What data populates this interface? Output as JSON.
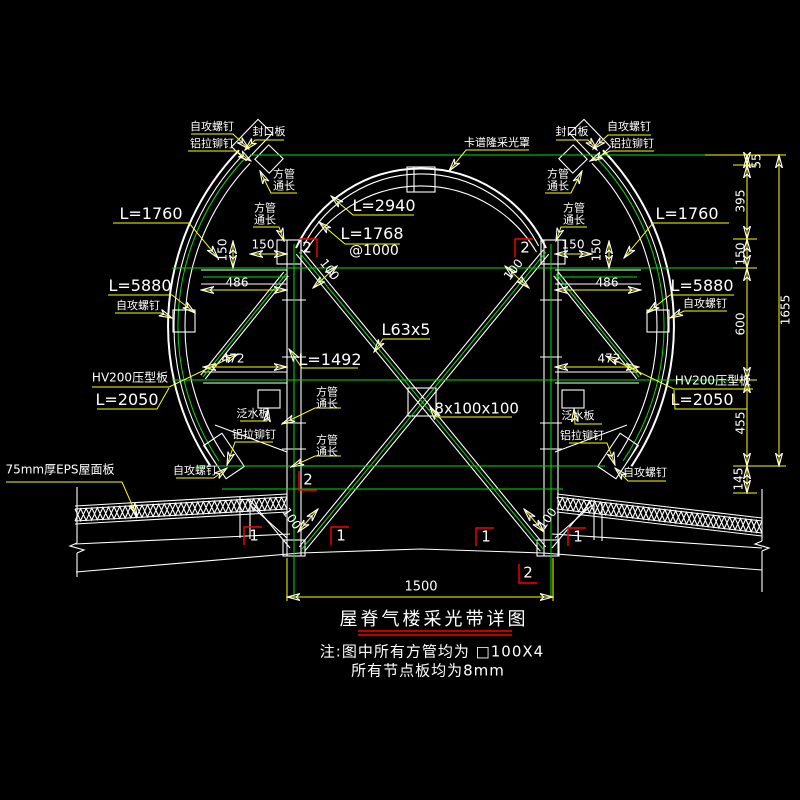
{
  "colors": {
    "background": "#000000",
    "line_white": "#ffffff",
    "axis_green": "#00e000",
    "dim_yellow": "#ffff00",
    "marker_red": "#ff0000"
  },
  "title_block": {
    "title": "屋脊气楼采光带详图",
    "note_line1": "注:图中所有方管均为 □100X4",
    "note_line2": "所有节点板均为8mm"
  },
  "annotations": [
    {
      "n": "screw-label-top-left",
      "t": "自攻螺钉",
      "x": 212,
      "y": 127,
      "fs": 11
    },
    {
      "n": "rivet-label-top-left",
      "t": "铝拉铆钉",
      "x": 212,
      "y": 144,
      "fs": 11
    },
    {
      "n": "seal-plate-label-left",
      "t": "封口板",
      "x": 269,
      "y": 132,
      "fs": 11
    },
    {
      "n": "square-tube-label-top-left",
      "t": "方管\n通长",
      "x": 284,
      "y": 181,
      "fs": 11
    },
    {
      "n": "square-tube-label-left-2",
      "t": "方管\n通长",
      "x": 265,
      "y": 215,
      "fs": 11
    },
    {
      "n": "skylight-cover-label",
      "t": "卡谱隆采光罩",
      "x": 497,
      "y": 143,
      "fs": 11
    },
    {
      "n": "seal-plate-label-right",
      "t": "封口板",
      "x": 572,
      "y": 132,
      "fs": 11
    },
    {
      "n": "screw-label-top-right",
      "t": "自攻螺钉",
      "x": 629,
      "y": 127,
      "fs": 11
    },
    {
      "n": "rivet-label-top-right",
      "t": "铝拉铆钉",
      "x": 632,
      "y": 144,
      "fs": 11
    },
    {
      "n": "square-tube-label-top-right",
      "t": "方管\n通长",
      "x": 558,
      "y": 181,
      "fs": 11
    },
    {
      "n": "square-tube-label-right-2",
      "t": "方管\n通长",
      "x": 574,
      "y": 215,
      "fs": 11
    },
    {
      "n": "length-1760-left",
      "t": "L=1760",
      "x": 151,
      "y": 214,
      "fs": 16
    },
    {
      "n": "length-1760-right",
      "t": "L=1760",
      "x": 687,
      "y": 214,
      "fs": 16
    },
    {
      "n": "length-2940",
      "t": "L=2940",
      "x": 384,
      "y": 206,
      "fs": 16
    },
    {
      "n": "length-1768",
      "t": "L=1768",
      "x": 372,
      "y": 234,
      "fs": 16
    },
    {
      "n": "spacing-1000",
      "t": "@1000",
      "x": 374,
      "y": 252,
      "fs": 14
    },
    {
      "n": "length-5880-left",
      "t": "L=5880",
      "x": 140,
      "y": 286,
      "fs": 16
    },
    {
      "n": "screw-label-mid-left",
      "t": "自攻螺钉",
      "x": 138,
      "y": 306,
      "fs": 11
    },
    {
      "n": "length-5880-right",
      "t": "L=5880",
      "x": 702,
      "y": 286,
      "fs": 16
    },
    {
      "n": "screw-label-mid-right",
      "t": "自攻螺钉",
      "x": 705,
      "y": 304,
      "fs": 11
    },
    {
      "n": "hv200-label-left",
      "t": "HV200压型板",
      "x": 130,
      "y": 378,
      "fs": 12
    },
    {
      "n": "length-2050-left",
      "t": "L=2050",
      "x": 127,
      "y": 400,
      "fs": 16
    },
    {
      "n": "hv200-label-right",
      "t": "HV200压型板",
      "x": 713,
      "y": 381,
      "fs": 12
    },
    {
      "n": "length-2050-right",
      "t": "L=2050",
      "x": 702,
      "y": 400,
      "fs": 16
    },
    {
      "n": "angle-steel-label",
      "t": "L63x5",
      "x": 406,
      "y": 330,
      "fs": 16
    },
    {
      "n": "length-1492",
      "t": "L=1492",
      "x": 330,
      "y": 360,
      "fs": 16
    },
    {
      "n": "gusset-plate-label",
      "t": "-8x100x100",
      "x": 474,
      "y": 409,
      "fs": 15
    },
    {
      "n": "square-tube-label-col-mid",
      "t": "方管\n通长",
      "x": 327,
      "y": 399,
      "fs": 11
    },
    {
      "n": "square-tube-label-col-low",
      "t": "方管\n通长",
      "x": 327,
      "y": 447,
      "fs": 11
    },
    {
      "n": "flashing-label-left",
      "t": "泛水板",
      "x": 253,
      "y": 414,
      "fs": 11
    },
    {
      "n": "rivet-label-bottom-left",
      "t": "铝拉铆钉",
      "x": 254,
      "y": 435,
      "fs": 11
    },
    {
      "n": "screw-label-bottom-left",
      "t": "自攻螺钉",
      "x": 195,
      "y": 471,
      "fs": 11
    },
    {
      "n": "flashing-label-right",
      "t": "泛水板",
      "x": 578,
      "y": 416,
      "fs": 11
    },
    {
      "n": "rivet-label-bottom-right",
      "t": "铝拉铆钉",
      "x": 582,
      "y": 436,
      "fs": 11
    },
    {
      "n": "screw-label-bottom-right",
      "t": "自攻螺钉",
      "x": 645,
      "y": 473,
      "fs": 11
    },
    {
      "n": "eps-roof-label",
      "t": "75mm厚EPS屋面板",
      "x": 60,
      "y": 470,
      "fs": 12
    },
    {
      "n": "dim-150-left-h",
      "t": "150",
      "x": 263,
      "y": 245,
      "fs": 12
    },
    {
      "n": "dim-150-left-v",
      "t": "150",
      "x": 223,
      "y": 250,
      "fs": 12,
      "rot": -90
    },
    {
      "n": "dim-150-right-h",
      "t": "150",
      "x": 573,
      "y": 245,
      "fs": 12
    },
    {
      "n": "dim-150-right-v",
      "t": "150",
      "x": 597,
      "y": 250,
      "fs": 12,
      "rot": -90
    },
    {
      "n": "dim-486-left",
      "t": "486",
      "x": 237,
      "y": 283,
      "fs": 12
    },
    {
      "n": "dim-486-right",
      "t": "486",
      "x": 607,
      "y": 283,
      "fs": 12
    },
    {
      "n": "dim-472-left",
      "t": "472",
      "x": 233,
      "y": 359,
      "fs": 12
    },
    {
      "n": "dim-472-right",
      "t": "472",
      "x": 609,
      "y": 359,
      "fs": 12
    },
    {
      "n": "dim-100-top-left",
      "t": "100",
      "x": 329,
      "y": 270,
      "fs": 12,
      "rot": 52
    },
    {
      "n": "dim-100-top-right",
      "t": "100",
      "x": 514,
      "y": 270,
      "fs": 12,
      "rot": -52
    },
    {
      "n": "dim-100-bottom-left",
      "t": "100",
      "x": 291,
      "y": 519,
      "fs": 12,
      "rot": 55
    },
    {
      "n": "dim-100-bottom-right",
      "t": "100",
      "x": 548,
      "y": 519,
      "fs": 12,
      "rot": -55
    },
    {
      "n": "dim-1500",
      "t": "1500",
      "x": 421,
      "y": 588,
      "fs": 13
    },
    {
      "n": "dim-55",
      "t": "55",
      "x": 757,
      "y": 161,
      "fs": 12,
      "rot": -90
    },
    {
      "n": "dim-395",
      "t": "395",
      "x": 741,
      "y": 201,
      "fs": 12,
      "rot": -90
    },
    {
      "n": "dim-150-chain",
      "t": "150",
      "x": 741,
      "y": 254,
      "fs": 12,
      "rot": -90
    },
    {
      "n": "dim-600",
      "t": "600",
      "x": 741,
      "y": 324,
      "fs": 12,
      "rot": -90
    },
    {
      "n": "dim-455",
      "t": "455",
      "x": 741,
      "y": 423,
      "fs": 12,
      "rot": -90
    },
    {
      "n": "dim-145",
      "t": "145",
      "x": 739,
      "y": 479,
      "fs": 12,
      "rot": -90
    },
    {
      "n": "dim-1655",
      "t": "1655",
      "x": 786,
      "y": 310,
      "fs": 12,
      "rot": -90
    },
    {
      "n": "marker-2-top-left",
      "t": "2",
      "x": 307,
      "y": 248,
      "fs": 15
    },
    {
      "n": "marker-2-top-right",
      "t": "2",
      "x": 525,
      "y": 248,
      "fs": 15
    },
    {
      "n": "marker-2-bottom-left",
      "t": "2",
      "x": 308,
      "y": 480,
      "fs": 15
    },
    {
      "n": "marker-2-bottom-right",
      "t": "2",
      "x": 528,
      "y": 573,
      "fs": 15
    },
    {
      "n": "marker-1-left-a",
      "t": "1",
      "x": 254,
      "y": 536,
      "fs": 15
    },
    {
      "n": "marker-1-left-b",
      "t": "1",
      "x": 341,
      "y": 536,
      "fs": 15
    },
    {
      "n": "marker-1-right-a",
      "t": "1",
      "x": 486,
      "y": 537,
      "fs": 15
    },
    {
      "n": "marker-1-right-b",
      "t": "1",
      "x": 578,
      "y": 537,
      "fs": 15
    }
  ]
}
